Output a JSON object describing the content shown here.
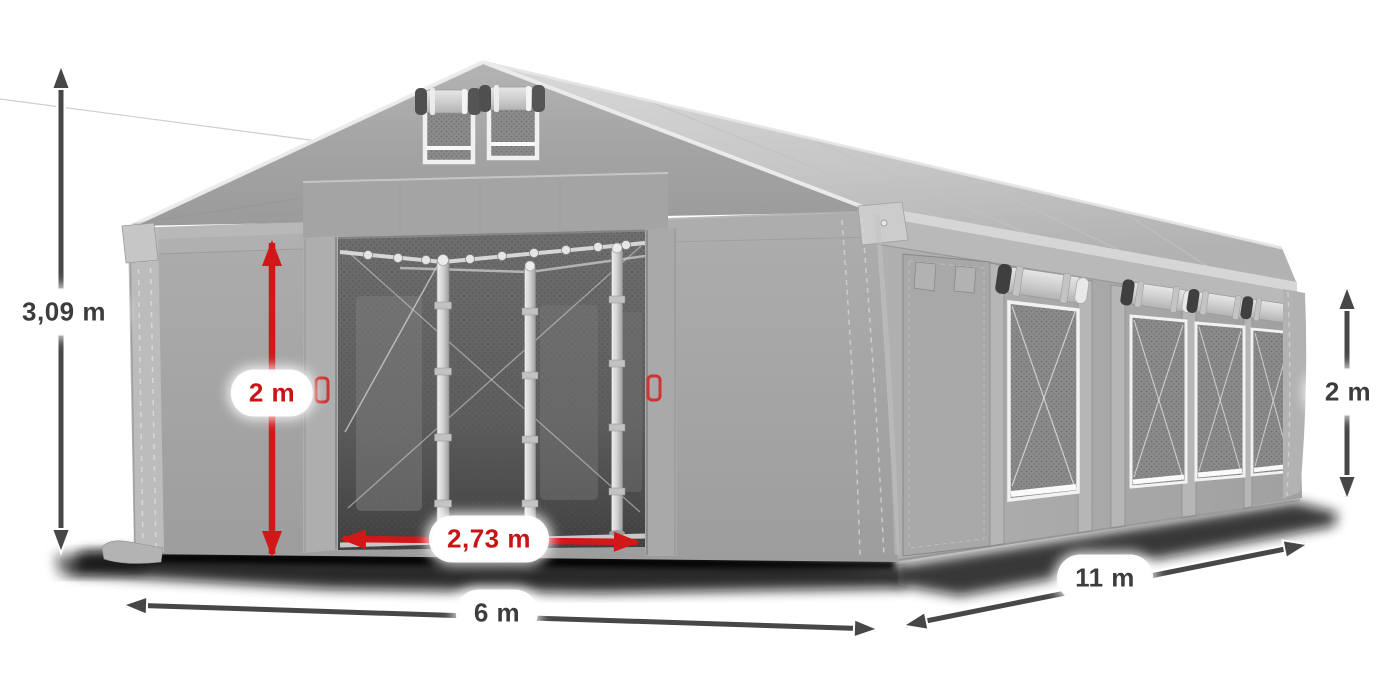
{
  "illustration": {
    "subject": "Grey marquee tent 3D render with open front entrance, two gable vents, side door and four mesh side windows, annotated with dimension arrows",
    "background": "#ffffff"
  },
  "colors": {
    "tent_fabric": "#a6a6a6",
    "roof": "#c9c9c9",
    "interior_dark": "#565656",
    "arrow_gray": "#474747",
    "arrow_red": "#d11717",
    "label_text_dark": "#3d3d3d",
    "label_text_red": "#c81414",
    "label_background": "#ffffff"
  },
  "labels": {
    "total_height": "3,09 m",
    "entrance_height": "2 m",
    "entrance_width": "2,73 m",
    "front_width": "6 m",
    "side_length": "11 m",
    "side_height": "2 m"
  }
}
